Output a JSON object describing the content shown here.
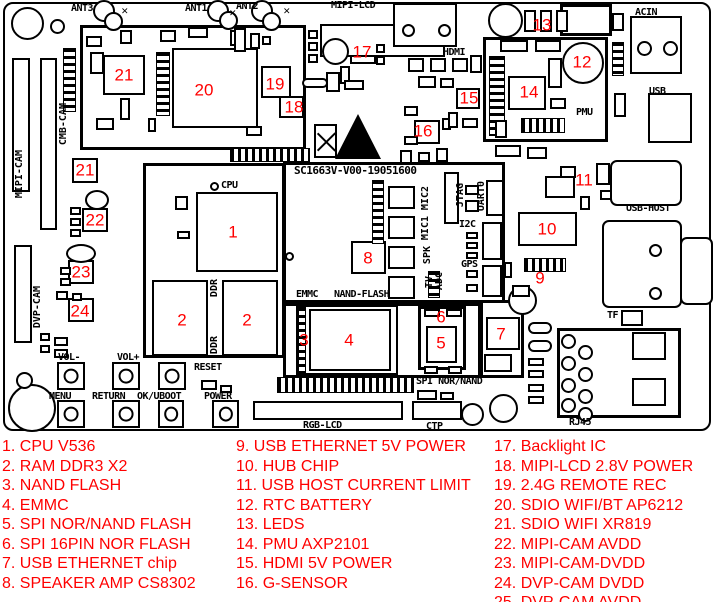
{
  "colors": {
    "callout_red": "#ff0000",
    "line_black": "#000000",
    "background": "#ffffff"
  },
  "board": {
    "id_text": "SC1663V-V00-19051600",
    "labels": [
      {
        "t": "ANT3",
        "x": 71,
        "y": 3
      },
      {
        "t": "ANT1",
        "x": 185,
        "y": 3
      },
      {
        "t": "ANT2",
        "x": 236,
        "y": 1
      },
      {
        "t": "MIPI-LCD",
        "x": 331,
        "y": 0
      },
      {
        "t": "HDMI",
        "x": 443,
        "y": 47
      },
      {
        "t": "ACIN",
        "x": 635,
        "y": 7
      },
      {
        "t": "USB",
        "x": 649,
        "y": 86
      },
      {
        "t": "PMU",
        "x": 576,
        "y": 107
      },
      {
        "t": "CPU",
        "x": 221,
        "y": 180
      },
      {
        "t": "VOL-",
        "x": 58,
        "y": 352
      },
      {
        "t": "VOL+",
        "x": 117,
        "y": 352
      },
      {
        "t": "RESET",
        "x": 194,
        "y": 362
      },
      {
        "t": "MENU",
        "x": 49,
        "y": 391
      },
      {
        "t": "RETURN",
        "x": 92,
        "y": 391
      },
      {
        "t": "OK/UBOOT",
        "x": 137,
        "y": 391
      },
      {
        "t": "POWER",
        "x": 204,
        "y": 391
      },
      {
        "t": "EMMC",
        "x": 296,
        "y": 289
      },
      {
        "t": "NAND-FLASH",
        "x": 334,
        "y": 289
      },
      {
        "t": "SPI NOR/NAND",
        "x": 416,
        "y": 376
      },
      {
        "t": "RGB-LCD",
        "x": 303,
        "y": 420
      },
      {
        "t": "CTP",
        "x": 426,
        "y": 421
      },
      {
        "t": "USB-HOST",
        "x": 626,
        "y": 203
      },
      {
        "t": "TF",
        "x": 607,
        "y": 310
      },
      {
        "t": "RJ45",
        "x": 569,
        "y": 417
      },
      {
        "t": "I2C",
        "x": 459,
        "y": 219
      },
      {
        "t": "GPS",
        "x": 461,
        "y": 259
      },
      {
        "t": "CMB-CAM",
        "x": 58,
        "y": 103,
        "v": 1
      },
      {
        "t": "MIPI-CAM",
        "x": 14,
        "y": 150,
        "v": 1
      },
      {
        "t": "DVP-CAM",
        "x": 32,
        "y": 286,
        "v": 1
      },
      {
        "t": "MIC2",
        "x": 420,
        "y": 186,
        "v": 1
      },
      {
        "t": "MIC1",
        "x": 420,
        "y": 216,
        "v": 1
      },
      {
        "t": "SPK",
        "x": 422,
        "y": 246,
        "v": 1
      },
      {
        "t": "TV",
        "x": 424,
        "y": 276,
        "v": 1
      },
      {
        "t": "ADC",
        "x": 434,
        "y": 272,
        "v": 1
      },
      {
        "t": "JTAG",
        "x": 455,
        "y": 183,
        "v": 1
      },
      {
        "t": "UART0",
        "x": 476,
        "y": 181,
        "v": 1
      },
      {
        "t": "DDR",
        "x": 209,
        "y": 279,
        "v": 1
      },
      {
        "t": "DDR",
        "x": 209,
        "y": 336,
        "v": 1
      }
    ],
    "callouts": [
      {
        "n": "1",
        "x": 233,
        "y": 232
      },
      {
        "n": "2",
        "x": 182,
        "y": 320
      },
      {
        "n": "2",
        "x": 247,
        "y": 320
      },
      {
        "n": "3",
        "x": 304,
        "y": 340
      },
      {
        "n": "4",
        "x": 349,
        "y": 340
      },
      {
        "n": "5",
        "x": 441,
        "y": 343
      },
      {
        "n": "6",
        "x": 441,
        "y": 317
      },
      {
        "n": "7",
        "x": 501,
        "y": 334
      },
      {
        "n": "8",
        "x": 368,
        "y": 258
      },
      {
        "n": "9",
        "x": 540,
        "y": 278
      },
      {
        "n": "10",
        "x": 547,
        "y": 229
      },
      {
        "n": "11",
        "x": 584,
        "y": 180
      },
      {
        "n": "12",
        "x": 582,
        "y": 62
      },
      {
        "n": "13",
        "x": 542,
        "y": 25
      },
      {
        "n": "14",
        "x": 529,
        "y": 92
      },
      {
        "n": "15",
        "x": 469,
        "y": 98
      },
      {
        "n": "16",
        "x": 423,
        "y": 131
      },
      {
        "n": "17",
        "x": 362,
        "y": 52
      },
      {
        "n": "18",
        "x": 294,
        "y": 107
      },
      {
        "n": "19",
        "x": 275,
        "y": 84
      },
      {
        "n": "20",
        "x": 204,
        "y": 90
      },
      {
        "n": "21",
        "x": 124,
        "y": 75
      },
      {
        "n": "21",
        "x": 85,
        "y": 170
      },
      {
        "n": "22",
        "x": 95,
        "y": 220
      },
      {
        "n": "23",
        "x": 81,
        "y": 272
      },
      {
        "n": "24",
        "x": 80,
        "y": 311
      }
    ]
  },
  "legend": {
    "columns": [
      {
        "x": 2,
        "items": [
          "1. CPU V536",
          "2. RAM DDR3 X2",
          "3. NAND FLASH",
          "4. EMMC",
          "5. SPI NOR/NAND FLASH",
          "6. SPI 16PIN NOR FLASH",
          "7. USB ETHERNET chip",
          "8. SPEAKER AMP CS8302"
        ]
      },
      {
        "x": 236,
        "items": [
          "9. USB ETHERNET 5V POWER",
          "10. HUB CHIP",
          "11. USB HOST CURRENT LIMIT",
          "12. RTC BATTERY",
          "13. LEDS",
          "14. PMU AXP2101",
          "15. HDMI 5V POWER",
          "16. G-SENSOR"
        ]
      },
      {
        "x": 494,
        "items": [
          "17. Backlight IC",
          "18. MIPI-LCD 2.8V POWER",
          "19. 2.4G REMOTE REC",
          "20. SDIO WIFI/BT AP6212",
          "21. SDIO WIFI XR819",
          "22. MIPI-CAM AVDD",
          "23. MIPI-CAM-DVDD",
          "24. DVP-CAM DVDD",
          "25. DVP-CAM AVDD"
        ]
      }
    ]
  }
}
